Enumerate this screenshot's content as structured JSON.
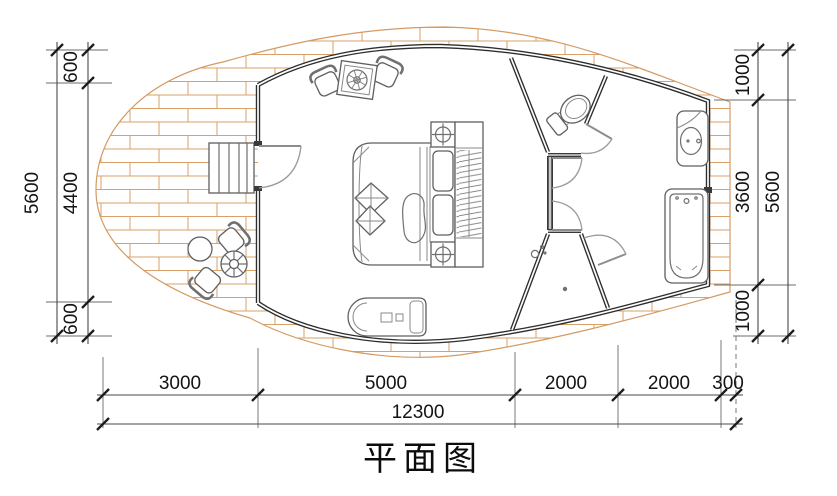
{
  "title": "平面图",
  "dims": {
    "left": {
      "overall": "5600",
      "segments": [
        "600",
        "4400",
        "600"
      ]
    },
    "right": {
      "overall": "5600",
      "segments": [
        "1000",
        "3600",
        "1000"
      ]
    },
    "bottom": {
      "overall": "12300",
      "segments": [
        "3000",
        "5000",
        "2000",
        "2000",
        "300"
      ]
    }
  },
  "colors": {
    "deck_line": "#d49a62",
    "wall": "#2d2d2d",
    "furniture_line": "#6f6f6f",
    "dimension_text": "#141414"
  }
}
